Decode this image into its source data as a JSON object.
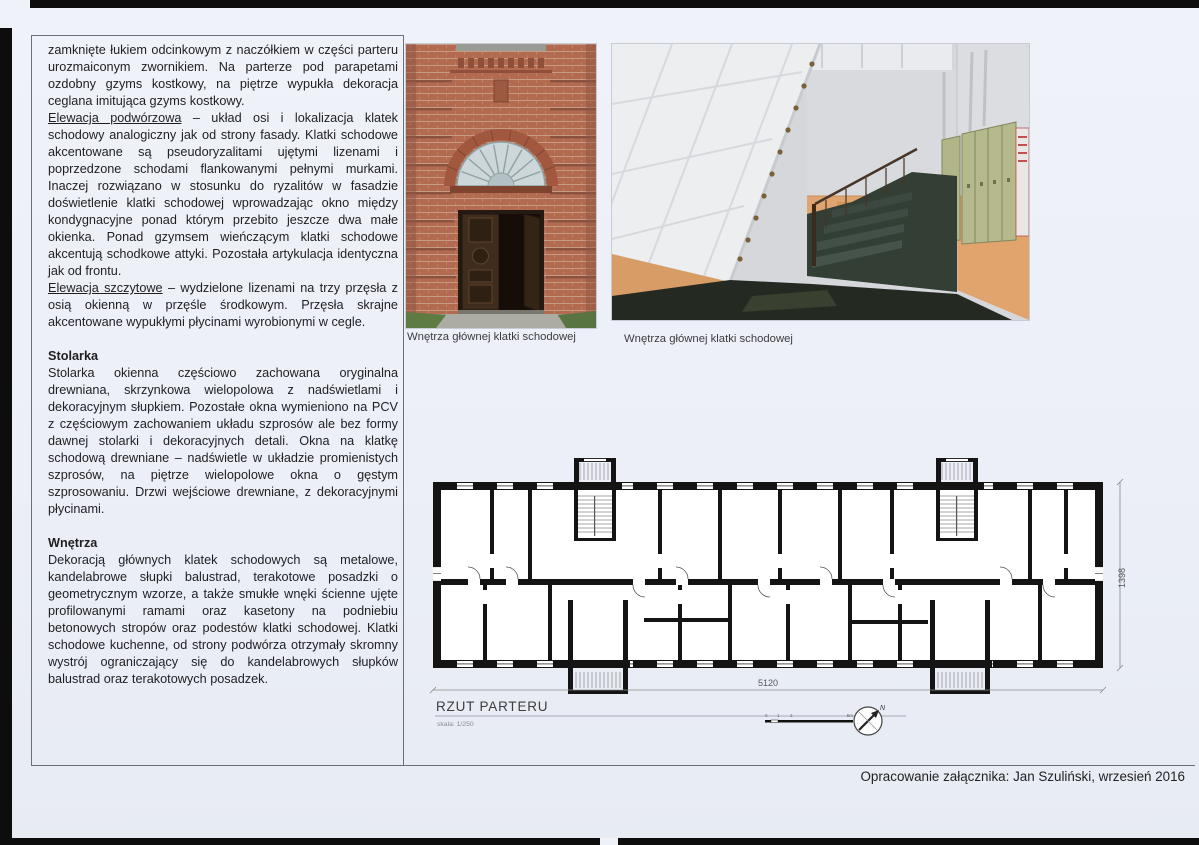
{
  "page": {
    "footer": "Opracowanie załącznika: Jan Szuliński, wrzesień 2016"
  },
  "text_column": {
    "p1": "zamknięte łukiem odcinkowym z naczółkiem w części parteru urozmaiconym zwornikiem. Na parterze pod parapetami ozdobny gzyms kostkowy, na piętrze wypukła dekoracja ceglana imitująca gzyms kostkowy.",
    "p2_lead": "Elewacja podwórzowa",
    "p2_rest": " – układ osi i lokalizacja klatek schodowy analogiczny jak od strony fasady. Klatki schodowe akcentowane są pseudoryzalitami ujętymi lizenami i poprzedzone schodami flankowanymi pełnymi murkami. Inaczej rozwiązano w stosunku do ryzalitów w fasadzie doświetlenie klatki schodowej wprowadzając okno między kondygnacyjne ponad którym przebito jeszcze dwa małe okienka. Ponad gzymsem wieńczącym klatki schodowe akcentują schodkowe attyki. Pozostała artykulacja identyczna jak od frontu.",
    "p3_lead": "Elewacja szczytowe",
    "p3_rest": " – wydzielone lizenami na trzy przęsła z osią okienną w przęśle środkowym. Przęsła skrajne akcentowane wypukłymi płycinami wyrobionymi w cegle.",
    "h_stolarka": "Stolarka",
    "p4": "Stolarka okienna częściowo zachowana oryginalna drewniana, skrzynkowa wielopolowa z nadświetlami i dekoracyjnym słupkiem. Pozostałe okna wymieniono na PCV z częściowym zachowaniem układu szprosów ale bez formy dawnej stolarki i dekoracyjnych detali. Okna na klatkę schodową drewniane – nadświetle w układzie promienistych szprosów, na piętrze wielopolowe okna o gęstym szprosowaniu. Drzwi wejściowe drewniane, z dekoracyjnymi płycinami.",
    "h_wnetrza": "Wnętrza",
    "p5": "Dekoracją głównych klatek schodowych są metalowe, kandelabrowe słupki balustrad, terakotowe posadzki o geometrycznym wzorze, a także smukłe wnęki ścienne ujęte profilowanymi ramami oraz kasetony na podniebiu betonowych stropów oraz podestów klatki schodowej. Klatki schodowe kuchenne, od strony podwórza otrzymały skromny wystrój ograniczający się do kandelabrowych słupków balustrad oraz terakotowych posadzek."
  },
  "photos": [
    {
      "caption": "Wnętrza głównej klatki schodowej"
    },
    {
      "caption": "Wnętrza głównej klatki schodowej"
    }
  ],
  "floor_plan": {
    "title": "RZUT PARTERU",
    "scale_label": "skala: 1/250",
    "width_dim": "5120",
    "height_dim": "1398",
    "scalebar": {
      "l0": "0",
      "l1": "1",
      "l2": "2",
      "l5": "5m"
    },
    "north": "N"
  },
  "colors": {
    "brick": "#b26b50",
    "wall_orange": "#dfa46f",
    "plan_wall": "#141414",
    "paper": "#eef1f8"
  }
}
